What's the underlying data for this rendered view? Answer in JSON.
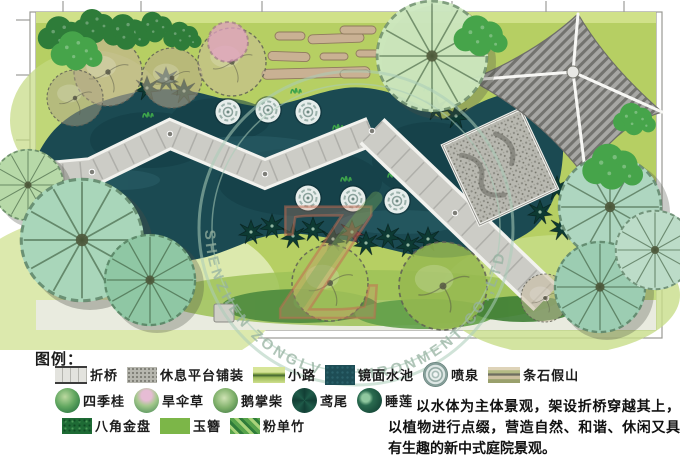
{
  "watermark": {
    "logo_letter": "Z",
    "ring_text": "SHENZHEN ZONGLV ENVIRONMENT CO.,LTD"
  },
  "legend": {
    "title": "图例：",
    "row1": [
      {
        "label": "折桥"
      },
      {
        "label": "休息平台铺装"
      },
      {
        "label": "小路"
      },
      {
        "label": "镜面水池"
      },
      {
        "label": "喷泉"
      },
      {
        "label": "条石假山"
      }
    ],
    "row2": [
      {
        "label": "四季桂"
      },
      {
        "label": "旱伞草"
      },
      {
        "label": "鹅掌柴"
      },
      {
        "label": "鸢尾"
      },
      {
        "label": "睡莲"
      }
    ],
    "row3": [
      {
        "label": "八角金盘"
      },
      {
        "label": "玉簪"
      },
      {
        "label": "粉单竹"
      }
    ]
  },
  "description": {
    "text": "以水体为主体景观，架设折桥穿越其上，以植物进行点缀，营造自然、和谐、休闲又具有生趣的新中式庭院景观。"
  },
  "colors": {
    "lawn": "#b6cf63",
    "water": "#1b4a52",
    "bridge": "#ccccc6",
    "roof": "#a7a7a4",
    "watermark_ring": "#abcdb9",
    "watermark_letter": "#d1886f"
  }
}
